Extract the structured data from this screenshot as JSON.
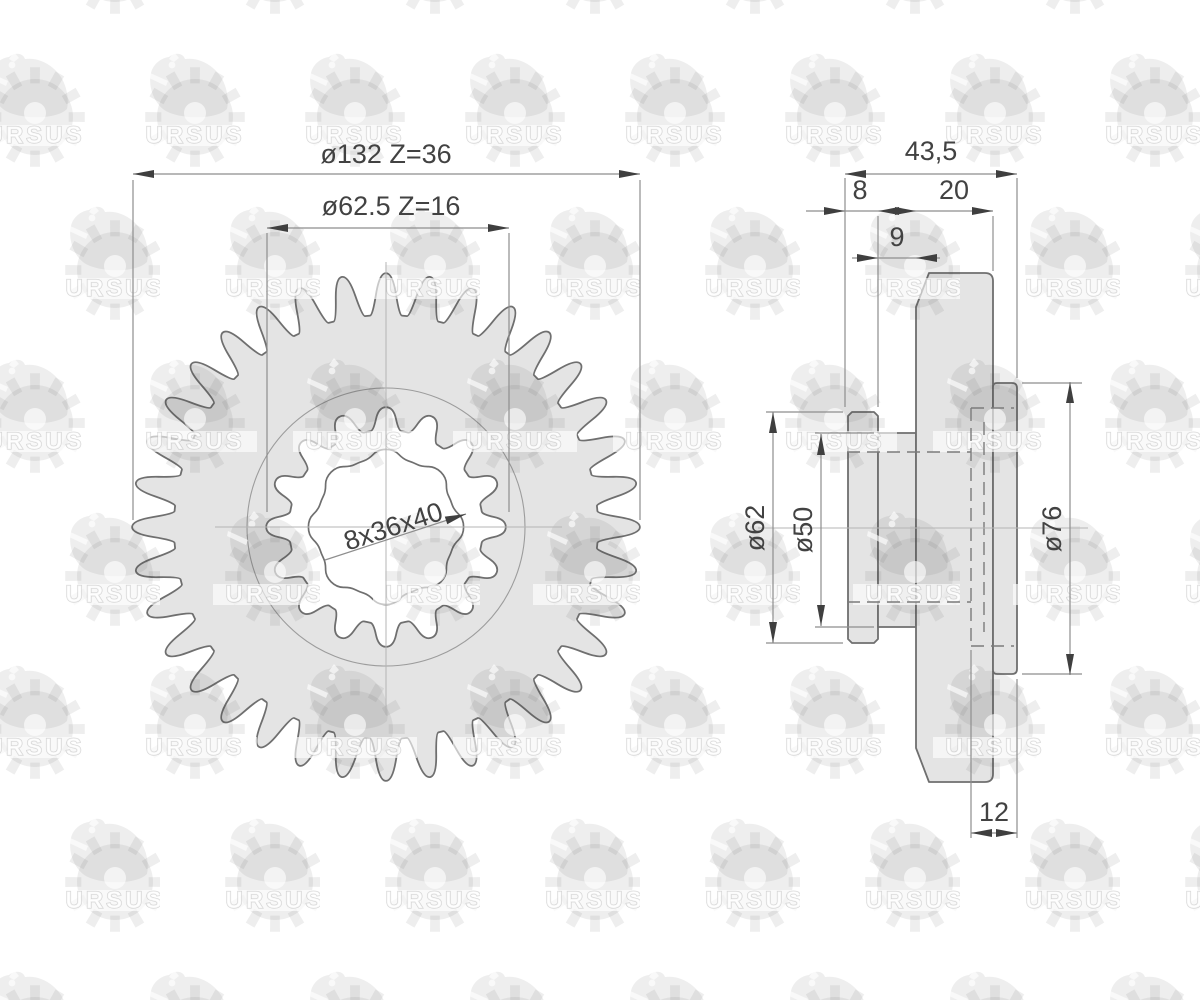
{
  "watermark": {
    "text": "URSUS"
  },
  "front_view": {
    "outer_gear": {
      "label": "ø132 Z=36",
      "teeth": 36,
      "diameter_mm": 132
    },
    "inner_gear": {
      "label": "ø62.5 Z=16",
      "teeth": 16,
      "diameter_mm": 62.5
    },
    "spline_bore": {
      "label": "8x36x40",
      "splines": 8,
      "minor_mm": 36,
      "major_mm": 40
    }
  },
  "side_view": {
    "dims": {
      "total_width": "43,5",
      "flange_width": "8",
      "web_offset": "9",
      "gear_width": "20",
      "flange_diameter": "ø62",
      "web_diameter": "ø50",
      "boss_diameter": "ø76",
      "recess_depth": "12"
    }
  }
}
